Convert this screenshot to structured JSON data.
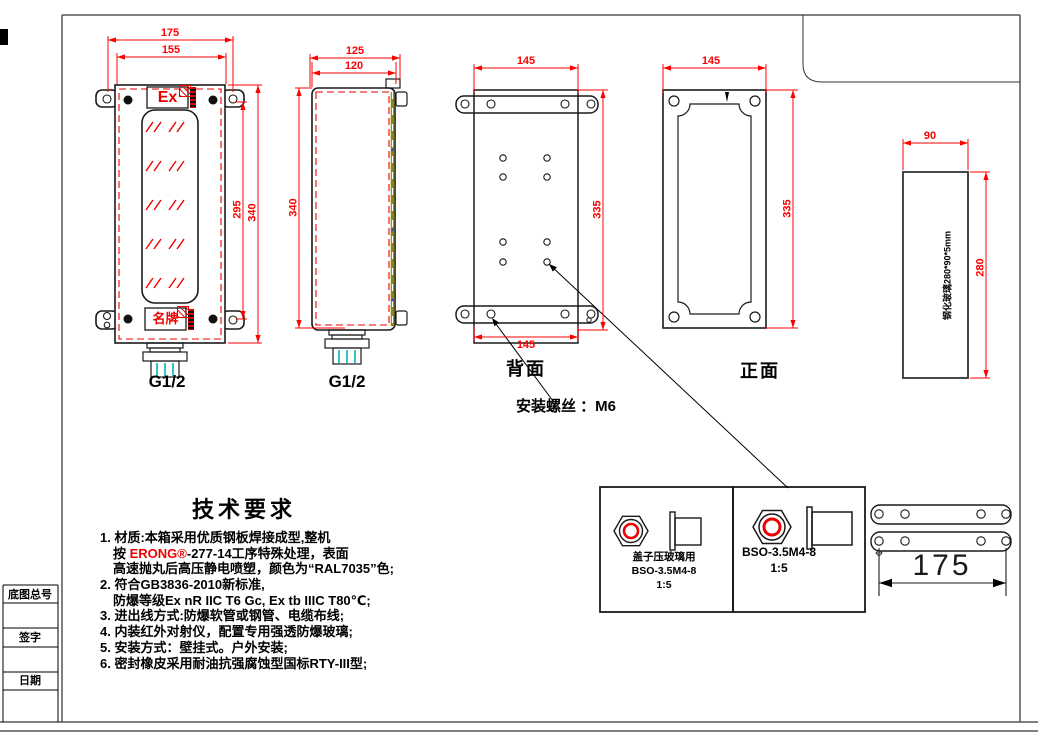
{
  "title_block": {
    "row1": "底图总号",
    "row2": "签字",
    "row3": "日期"
  },
  "views": {
    "front": {
      "dim_lug_span": "175",
      "dim_body_width": "155",
      "dim_inner_height": "295",
      "dim_body_height": "340",
      "ex_marking": "Ex",
      "nameplate": "名牌",
      "gland": "G1/2"
    },
    "side": {
      "dim_depth_outer": "125",
      "dim_depth_inner": "120",
      "dim_height": "340",
      "gland": "G1/2"
    },
    "back": {
      "dim_top": "145",
      "dim_height": "335",
      "dim_bottom": "145",
      "caption": "背面",
      "screw_note": "安装螺丝 ：M6"
    },
    "face": {
      "dim_width": "145",
      "dim_height": "335",
      "caption": "正面"
    },
    "glass": {
      "dim_width": "90",
      "dim_height": "280",
      "spec": "钢化玻璃280*90*5mm"
    }
  },
  "details": {
    "left": {
      "use_note": "盖子压玻璃用",
      "part": "BSO-3.5M4-8",
      "scale": "1:5"
    },
    "right": {
      "part": "BSO-3.5M4-8",
      "scale": "1:5"
    }
  },
  "mounting_strips": {
    "dim": "175"
  },
  "tech_requirements": {
    "title": "技术要求",
    "item1_line1": "1. 材质:本箱采用优质钢板焊接成型,整机",
    "item1_line2_prefix": "按 ",
    "item1_brand": "ERONG®",
    "item1_line2_suffix": "-277-14工序特殊处理，表面",
    "item1_line3": "高速抛丸后高压静电喷塑，颜色为“RAL7035”色;",
    "item2_line1": "2. 符合GB3836-2010新标准,",
    "item2_line2": "防爆等级Ex nR IIC T6 Gc, Ex tb IIIC T80℃;",
    "item3": "3. 进出线方式:防爆软管或钢管、电缆布线;",
    "item4": "4. 内装红外对射仪，配置专用强透防爆玻璃;",
    "item5": "5. 安装方式：壁挂式。户外安装;",
    "item6": "6. 密封橡皮采用耐油抗强腐蚀型国标RTY-III型;"
  },
  "colors": {
    "dimension_red": "#ff0000",
    "line_black": "#000000",
    "hinge_olive": "#8a8a00",
    "gland_cyan": "#00b7b7"
  }
}
